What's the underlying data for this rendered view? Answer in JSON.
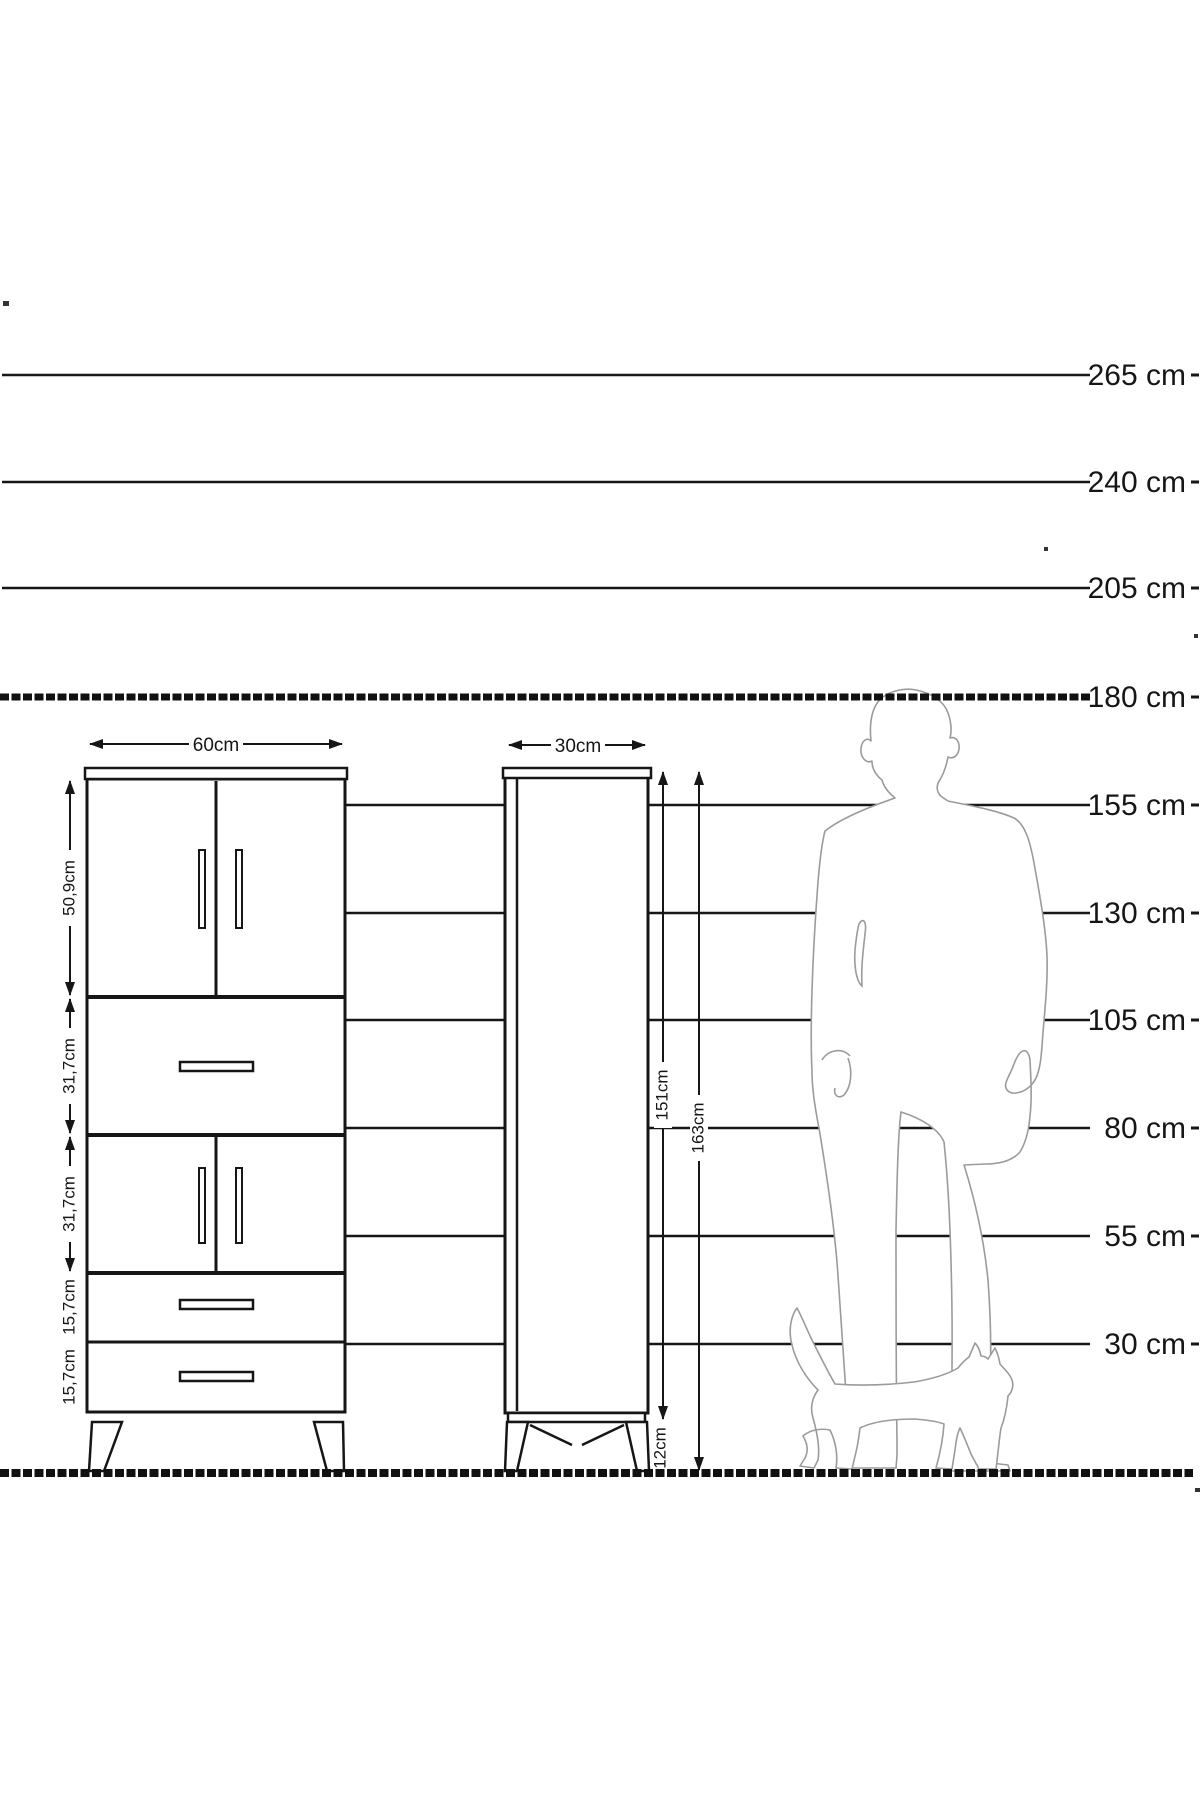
{
  "diagram": {
    "kind": "furniture-height-dimension-diagram",
    "height_scale": {
      "unit": "cm",
      "rows": [
        {
          "label": "265 cm"
        },
        {
          "label": "240 cm"
        },
        {
          "label": "205 cm"
        },
        {
          "label": "180 cm"
        },
        {
          "label": "155 cm"
        },
        {
          "label": "130 cm"
        },
        {
          "label": "105 cm"
        },
        {
          "label": "80 cm"
        },
        {
          "label": "55 cm"
        },
        {
          "label": "30 cm"
        }
      ]
    },
    "front_view": {
      "width_label": "60cm",
      "sections": [
        {
          "label": "50,9cm",
          "kind": "double-door"
        },
        {
          "label": "31,7cm",
          "kind": "drawer"
        },
        {
          "label": "31,7cm",
          "kind": "double-door"
        },
        {
          "label": "15,7cm",
          "kind": "drawer"
        },
        {
          "label": "15,7cm",
          "kind": "drawer"
        }
      ]
    },
    "side_view": {
      "width_label": "30cm",
      "body_height_label": "151cm",
      "total_height_label": "163cm",
      "leg_height_label": "12cm"
    },
    "figures": [
      "man-silhouette",
      "cat-silhouette"
    ],
    "colors": {
      "line": "#161616",
      "figure_outline": "#9b9b9b",
      "background": "#ffffff"
    }
  }
}
